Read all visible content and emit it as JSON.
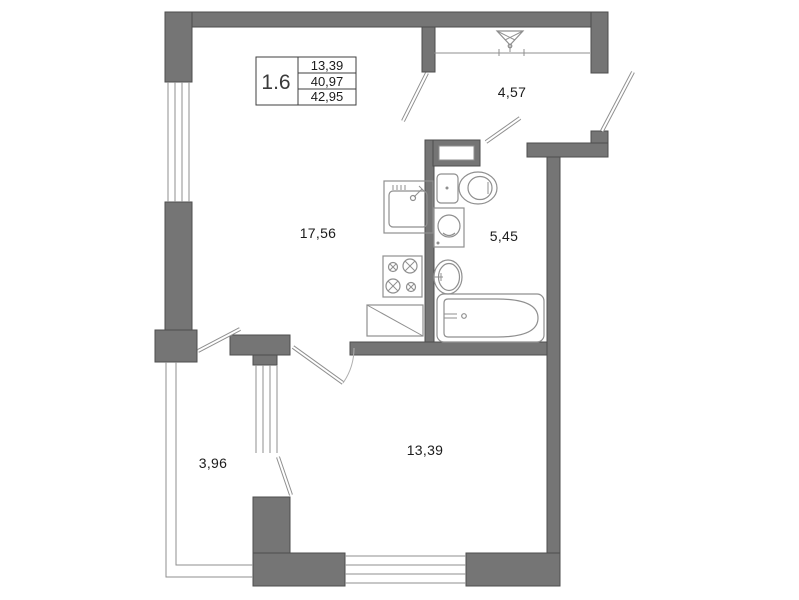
{
  "plan": {
    "title_block": {
      "unit": "1.6",
      "values": [
        "13,39",
        "40,97",
        "42,95"
      ]
    },
    "rooms": {
      "hallway": {
        "area": "4,57"
      },
      "kitchen_living": {
        "area": "17,56"
      },
      "bathroom": {
        "area": "5,45"
      },
      "balcony": {
        "area": "3,96"
      },
      "bedroom": {
        "area": "13,39"
      }
    },
    "colors": {
      "wall_fill": "#757575",
      "wall_edge": "#4d4d4d",
      "fixture_line": "#8f8f8f",
      "text": "#1c1c1c",
      "background": "#ffffff"
    }
  }
}
